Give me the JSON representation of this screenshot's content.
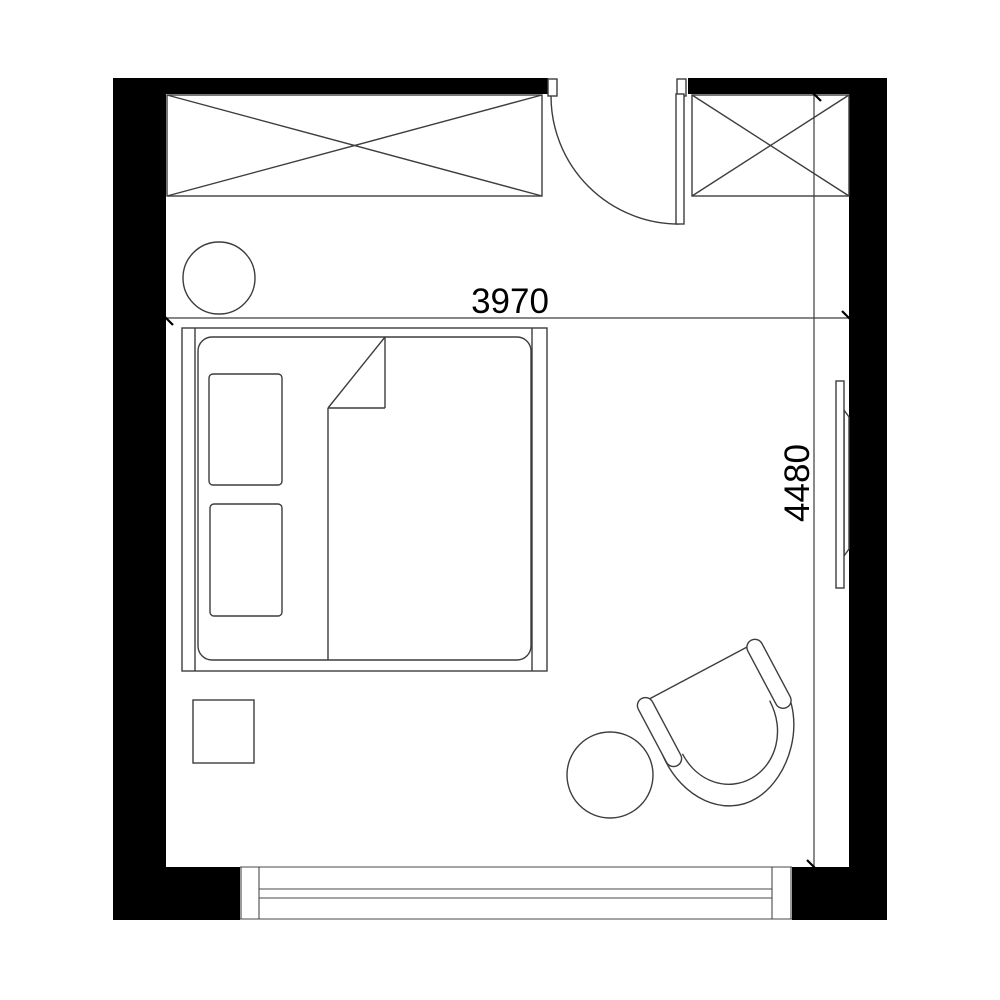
{
  "plan": {
    "type": "bedroom-floor-plan",
    "dimensions": {
      "width_label": "3970",
      "height_label": "4480"
    },
    "colors": {
      "wall": "#000000",
      "line": "#3d3d3d",
      "background": "#ffffff",
      "dimension_text": "#000000"
    },
    "symbols": [
      "wardrobe-crossed-box",
      "closet-crossed-box",
      "door-swing-arc",
      "double-bed-with-pillows-and-duvet",
      "nightstand-square",
      "stool-circle",
      "armchair-tub",
      "side-table-circle",
      "window-triple-line",
      "wall-tv-panel"
    ]
  }
}
